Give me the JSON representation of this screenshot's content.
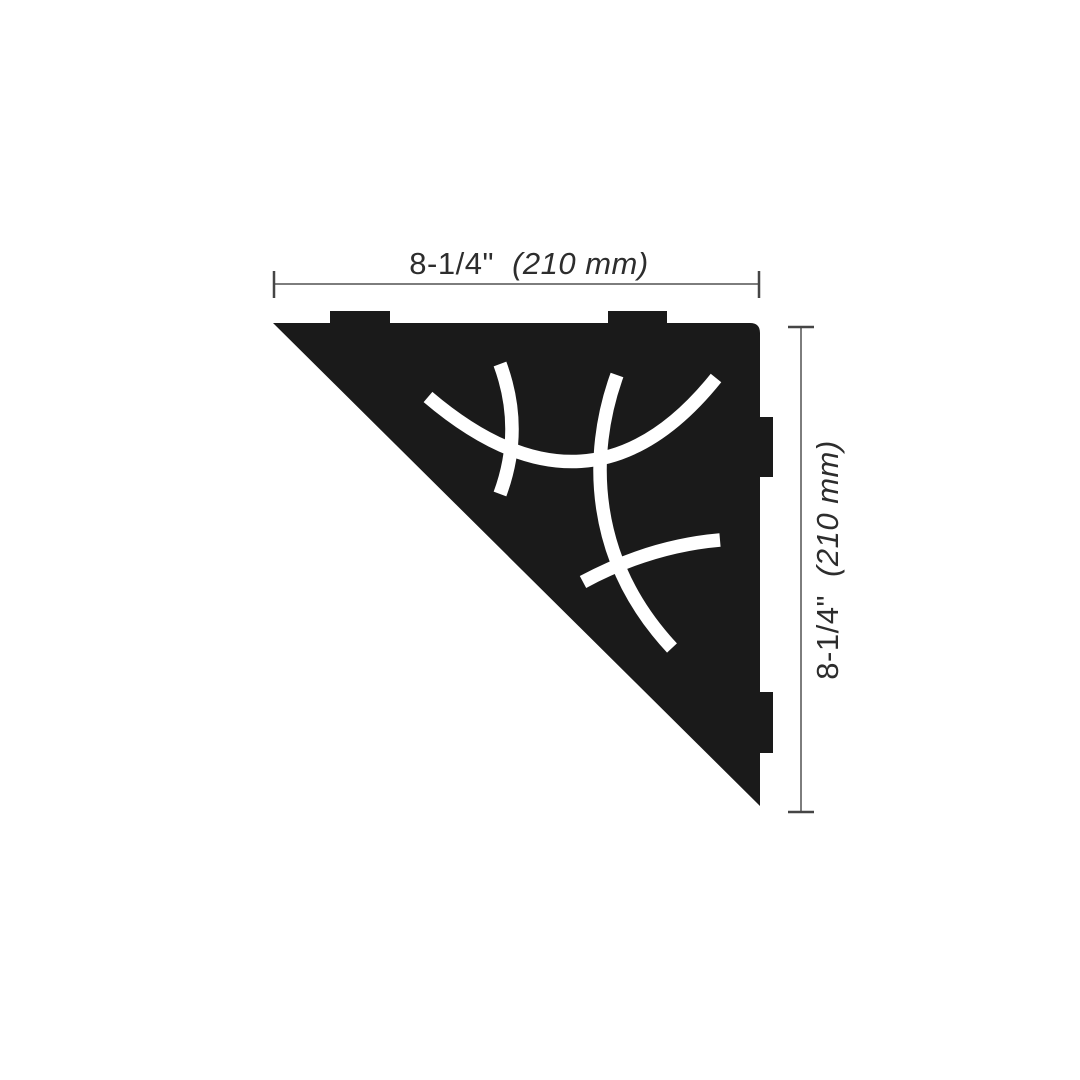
{
  "colors": {
    "background": "#ffffff",
    "shelf": "#1a1a1a",
    "cutout": "#ffffff",
    "dimension_line": "#7d7d7d",
    "tick": "#454545",
    "text": "#2d2d2d"
  },
  "dimensions": {
    "width": {
      "imperial": "8-1/4\"",
      "metric": "(210 mm)"
    },
    "height": {
      "imperial": "8-1/4\"",
      "metric": "(210 mm)"
    }
  }
}
